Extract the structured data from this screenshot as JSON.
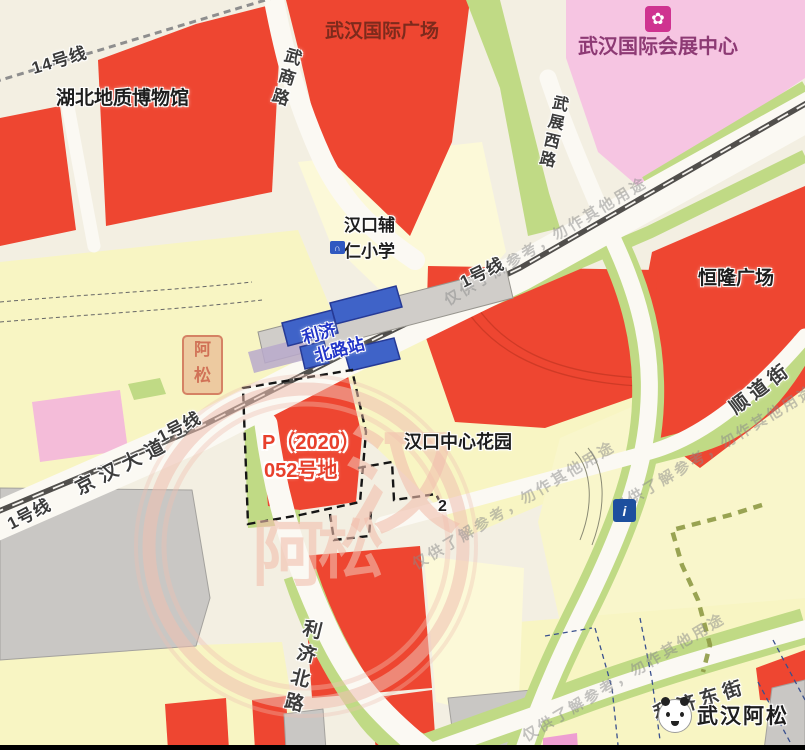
{
  "places": {
    "museum": "湖北地质博物馆",
    "intl_plaza": "武汉国际广场",
    "exhibition_center": "武汉国际会展中心",
    "hanglung_plaza": "恒隆广场",
    "primary_school": "汉口辅仁小学",
    "central_garden": "汉口中心花园"
  },
  "streets": {
    "wushang_rd": "武商路",
    "wuzhan_west_rd": "武展西路",
    "jinghan_ave": "京汉大道",
    "shundao_st": "顺道街",
    "liji_north_rd": "利济北路",
    "liji_east_st": "利济东街"
  },
  "metro": {
    "line1": "1号线",
    "line14": "14号线",
    "station_name": "利济北路站",
    "station_line1": "利济",
    "station_line2": "北路站"
  },
  "parcel": {
    "label_line1": "P（2020）",
    "label_line2": "052号地",
    "marker": "2"
  },
  "watermarks": {
    "notice": "仅供了解参考，勿作其他用途",
    "brand": "武汉阿松",
    "seal_char1": "阿",
    "seal_char2": "松",
    "big_char1": "汉",
    "big_char2": "阿",
    "big_char3": "松"
  },
  "colors": {
    "block_red": "#ee4631",
    "block_yellow": "#f8f5c3",
    "block_yellow_light": "#fcf9d8",
    "block_pink": "#f6c5e2",
    "block_gray": "#c9c7c4",
    "greenery": "#c0da85",
    "road": "#fbf9f3",
    "background": "#f3efe2",
    "rail": "#514f4c",
    "station_blue": "#3f63c8",
    "parcel_label_red": "#e8402c",
    "watermark_pink": "#f2bfae"
  }
}
